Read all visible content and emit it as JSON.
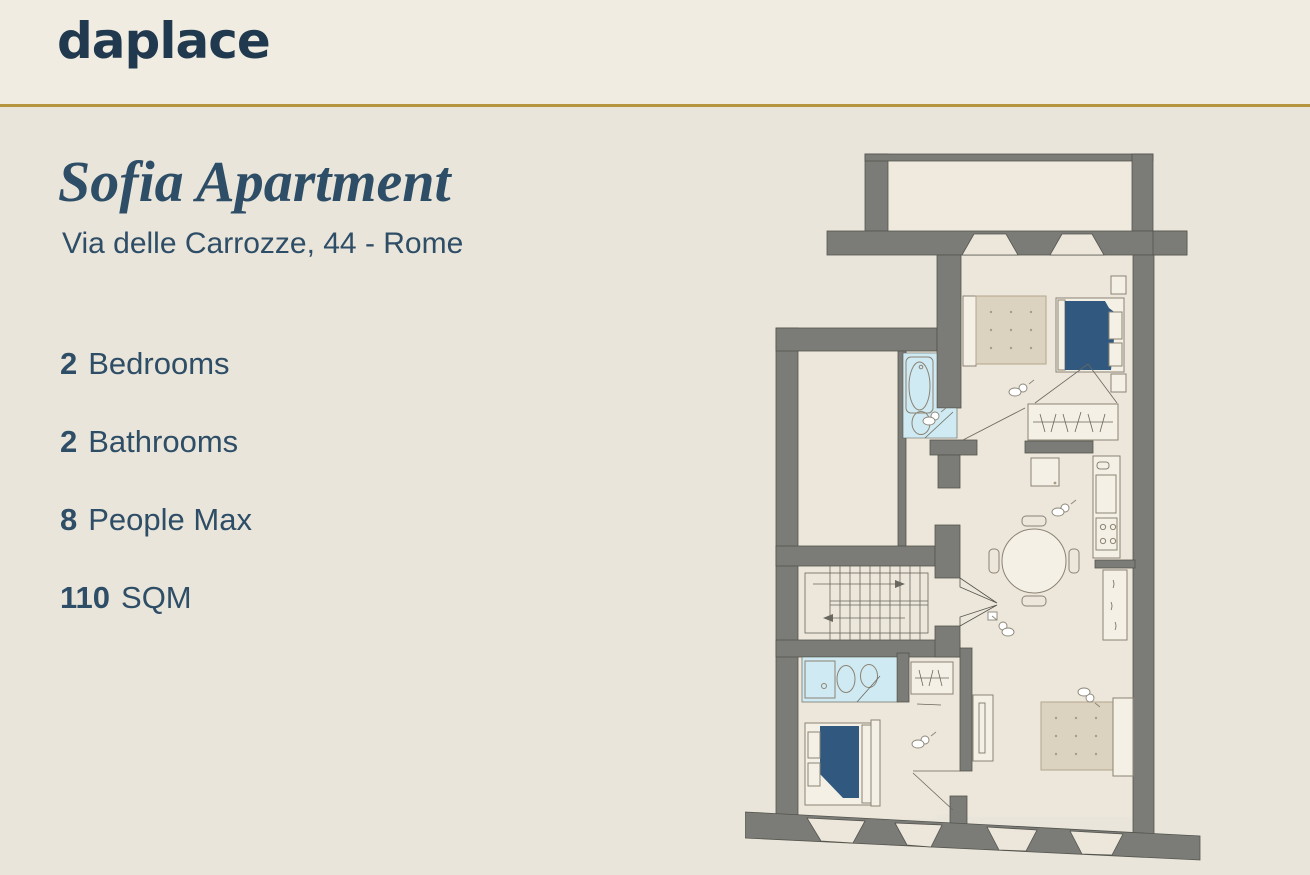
{
  "brand": {
    "logo_text": "daplace"
  },
  "listing": {
    "title": "Sofia Apartment",
    "address": "Via delle Carrozze, 44 - Rome"
  },
  "features": [
    {
      "value": "2",
      "label": "Bedrooms"
    },
    {
      "value": "2",
      "label": "Bathrooms"
    },
    {
      "value": "8",
      "label": "People Max"
    },
    {
      "value": "110",
      "label": "SQM"
    }
  ],
  "floorplan": {
    "kind": "apartment-floor-plan",
    "rooms": [
      "terrace",
      "bedroom-1",
      "bathroom-1",
      "storage-room",
      "hallway",
      "staircase",
      "living-dining-area",
      "kitchen",
      "bathroom-2",
      "bedroom-2"
    ]
  },
  "colors": {
    "bg": "#e9e5da",
    "header_bg": "#f0ece2",
    "divider_gold": "#b6953f",
    "brand_navy": "#21394e",
    "text_navy": "#2e4d66",
    "wall_gray": "#7b7b78",
    "floor_cream": "#ece6db",
    "bathroom_blue": "#cfeaf2",
    "bed_blue": "#31597f",
    "furniture_beige": "#dcd2c0"
  }
}
